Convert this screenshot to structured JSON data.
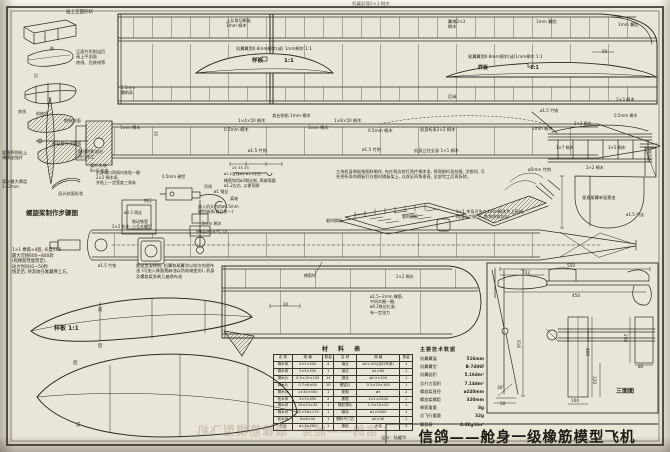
{
  "title_block": {
    "title": "信鸽——舱身一级橡筋模型飞机",
    "designer": "设计：陆耀华"
  },
  "material_table": {
    "title": "材  料  表",
    "headers": [
      "名 称",
      "规 格",
      "数量",
      "名 称",
      "规 格",
      "数量"
    ],
    "rows": [
      [
        "桐木条",
        "2×2×550",
        "4",
        "钢丝",
        "ø2×100(自行车条)",
        "1"
      ],
      [
        "桐木条",
        "2×3×550",
        "1",
        "钢丝",
        "ø1×80",
        "1"
      ],
      [
        "桐木片",
        "0.5×10×100",
        "14",
        "铜丝",
        "ø0.5×100",
        "1"
      ],
      [
        "桐木片",
        "0.7×8×80",
        "10",
        "硬铝片",
        "0.5×20×100",
        "1"
      ],
      [
        "桐木片",
        "1×30×550",
        "1",
        "垫圈",
        "ø5",
        "2"
      ],
      [
        "松木条",
        "3×3×550",
        "2",
        "橡筋",
        "1×1×2500",
        "1"
      ],
      [
        "桐木块",
        "10×25×35",
        "1",
        "橡胶薄片",
        "1.5×10×20",
        "1"
      ],
      [
        "桐木块",
        "22×36×170",
        "1",
        "蜡线",
        "ø1×5000",
        "1"
      ],
      [
        "松木块",
        "6×6×50",
        "1",
        "塑料气门芯",
        "ø2×30",
        "1"
      ],
      [
        "竹丝",
        "ø1.5×280",
        "1",
        "棉纸",
        "大张",
        "1"
      ]
    ]
  },
  "tech_data": {
    "title": "主要技术数据",
    "rows": [
      [
        "机翼翼展",
        "516mm"
      ],
      [
        "机翼翼型",
        "B-7406f"
      ],
      [
        "机翼面积",
        "5.16dm²"
      ],
      [
        "总升力面积",
        "7.14dm²"
      ],
      [
        "螺旋桨直径",
        "ø240mm"
      ],
      [
        "螺旋桨螺距",
        "320mm"
      ],
      [
        "橡筋重量",
        "8g"
      ],
      [
        "总飞行重量",
        "32g"
      ],
      [
        "翼载荷",
        "4.42g/dm²"
      ]
    ]
  },
  "labels": [
    {
      "t": "画上正面形状",
      "x": 66,
      "y": 10,
      "s": 4.5
    },
    {
      "t": "正面外形削出后\n画上平剖面\n棱线、后棱线等",
      "x": 76,
      "y": 49,
      "w": 38,
      "s": 4.2
    },
    {
      "t": "前",
      "x": 50,
      "y": 46,
      "s": 4
    },
    {
      "t": "后",
      "x": 34,
      "y": 73,
      "s": 4
    },
    {
      "t": "底线",
      "x": 18,
      "y": 109,
      "s": 4
    },
    {
      "t": "前棱线",
      "x": 36,
      "y": 111,
      "s": 4
    },
    {
      "t": "削制剖面",
      "x": 64,
      "y": 118,
      "s": 4.2
    },
    {
      "t": "紧贴桨叶成圆弧",
      "x": 52,
      "y": 141,
      "s": 4.2
    },
    {
      "t": "削除阴影部分\n再行加工",
      "x": 78,
      "y": 149,
      "w": 34,
      "s": 4.2
    },
    {
      "t": "桨根两侧贴上\n薄绸加强片",
      "x": 2,
      "y": 150,
      "w": 30,
      "s": 4.2
    },
    {
      "t": "桨叶木块\n8×8 松木",
      "x": 90,
      "y": 163,
      "w": 26,
      "s": 4.2
    },
    {
      "t": "桨叶最大厚度\n1~2mm",
      "x": 2,
      "y": 179,
      "w": 32,
      "s": 4.2
    },
    {
      "t": "设计剖面形状",
      "x": 58,
      "y": 191,
      "s": 4.2
    },
    {
      "t": "螺旋桨制作步骤图",
      "x": 26,
      "y": 209,
      "s": 6.5,
      "b": 1
    },
    {
      "t": "机翼前缘2×3 桐木",
      "x": 352,
      "y": 2,
      "s": 4.5
    },
    {
      "t": "上反角切断处\n1mm 桐木",
      "x": 226,
      "y": 18,
      "w": 34,
      "s": 4.2
    },
    {
      "t": "机翼翼肋0.8mm桐木(或) 1mm桐木 1:1",
      "x": 236,
      "y": 46,
      "s": 4.2
    },
    {
      "t": "样板",
      "x": 252,
      "y": 58,
      "s": 5.5,
      "b": 1
    },
    {
      "t": "1:1",
      "x": 284,
      "y": 58,
      "s": 5.5,
      "b": 1
    },
    {
      "t": "翼梢2×3\n桐木",
      "x": 448,
      "y": 19,
      "w": 26,
      "s": 4.2
    },
    {
      "t": "1mm 翼肋",
      "x": 536,
      "y": 19,
      "s": 4.2
    },
    {
      "t": "1mm 翼肋",
      "x": 618,
      "y": 22,
      "s": 4.2
    },
    {
      "t": "尾翼翼肋0.8mm桐木(或)1mm桐木 1:1",
      "x": 468,
      "y": 54,
      "s": 4.2
    },
    {
      "t": "样板",
      "x": 478,
      "y": 65,
      "s": 5,
      "b": 1
    },
    {
      "t": "1:1",
      "x": 530,
      "y": 65,
      "s": 5,
      "b": 1
    },
    {
      "t": "50",
      "x": 602,
      "y": 49,
      "s": 4.2
    },
    {
      "t": "后缘",
      "x": 448,
      "y": 94,
      "s": 4.2
    },
    {
      "t": "2×3 桐木",
      "x": 616,
      "y": 97,
      "s": 4.2
    },
    {
      "t": "1.5mm\n翼梢条",
      "x": 121,
      "y": 85,
      "w": 22,
      "s": 4
    },
    {
      "t": "1mm 桐木",
      "x": 120,
      "y": 125,
      "s": 4.2
    },
    {
      "t": "35",
      "x": 158,
      "y": 131,
      "s": 4,
      "r": 90
    },
    {
      "t": "1×4×50 桐木",
      "x": 238,
      "y": 118,
      "s": 4.2
    },
    {
      "t": "其右侧贴 1mm 桐木",
      "x": 272,
      "y": 113,
      "s": 4.2
    },
    {
      "t": "0.5mm 桐木",
      "x": 224,
      "y": 127,
      "s": 4.2
    },
    {
      "t": "1mm 桐木",
      "x": 308,
      "y": 125,
      "s": 4.2
    },
    {
      "t": "ø1.5 竹销",
      "x": 248,
      "y": 148,
      "s": 4.2
    },
    {
      "t": "1×8×50 桐木",
      "x": 334,
      "y": 118,
      "s": 4.2
    },
    {
      "t": "0.5mm 桐木",
      "x": 368,
      "y": 128,
      "s": 4.2
    },
    {
      "t": "机身桁条2×2 桐木",
      "x": 420,
      "y": 127,
      "s": 4.2
    },
    {
      "t": "1mm 桐木",
      "x": 532,
      "y": 126,
      "s": 4.2
    },
    {
      "t": "ø1.5 竹销",
      "x": 362,
      "y": 147,
      "s": 4.2
    },
    {
      "t": "机身立柱全部 1×1 桐木",
      "x": 414,
      "y": 148,
      "s": 4.2
    },
    {
      "t": "ø5mm 竹销",
      "x": 528,
      "y": 167,
      "s": 4.2
    },
    {
      "t": "25    35    25",
      "x": 232,
      "y": 166,
      "s": 3.8
    },
    {
      "t": "ø1.2左右  ø2  ø1.2左右",
      "x": 224,
      "y": 172,
      "s": 3.6
    },
    {
      "t": "橡筋钩用ø2钢丝制, 两端弯圆\nø1.2左右, 以便弯脚",
      "x": 224,
      "y": 178,
      "w": 66,
      "s": 4
    },
    {
      "t": "机身端口四周内各贴一圈\n2×2 桐木条,\n并贴上一定宽度三角条",
      "x": 96,
      "y": 170,
      "w": 62,
      "s": 4
    },
    {
      "t": "0.5mm 硬铝",
      "x": 162,
      "y": 174,
      "s": 4
    },
    {
      "t": "吊线",
      "x": 204,
      "y": 184,
      "s": 4
    },
    {
      "t": "ø1 钢丝",
      "x": 214,
      "y": 189,
      "s": 4
    },
    {
      "t": "桨轴",
      "x": 230,
      "y": 196,
      "s": 4
    },
    {
      "t": "热压",
      "x": 144,
      "y": 198,
      "s": 4
    },
    {
      "t": "ø0.3 铜丝",
      "x": 124,
      "y": 210,
      "s": 4
    },
    {
      "t": "嵌入机头内的ø0.5mm\n硬铝轴承(前后各一)",
      "x": 198,
      "y": 204,
      "w": 58,
      "s": 4
    },
    {
      "t": "制动铁管\n小号木螺钉",
      "x": 132,
      "y": 219,
      "w": 28,
      "s": 4
    },
    {
      "t": "2mm 桐木",
      "x": 202,
      "y": 221,
      "s": 4
    },
    {
      "t": "塑料自行车气门芯",
      "x": 196,
      "y": 229,
      "s": 4
    },
    {
      "t": "2×2 松木",
      "x": 112,
      "y": 224,
      "s": 4
    },
    {
      "t": "三块机身侧板按图样制作, 先在两边各钉两片桐木条, 将两根桁条刨直, 涂胶时, 可先把桁条和隔板钉在临时隔板架上, 以保证四角垂直, 全部完工后再拆除。",
      "x": 336,
      "y": 169,
      "w": 152,
      "s": 4.2
    },
    {
      "t": "临时隔板",
      "x": 326,
      "y": 218,
      "s": 4
    },
    {
      "t": "临时隔板",
      "x": 402,
      "y": 214,
      "s": 4
    },
    {
      "t": "1×1 木条可先在1mm桐木片上画线,\n再用小刀割下, 其木质较均匀",
      "x": 456,
      "y": 209,
      "w": 104,
      "s": 4.2
    },
    {
      "t": "ø1.5 竹销",
      "x": 540,
      "y": 108,
      "s": 4
    },
    {
      "t": "2×3 桐木",
      "x": 574,
      "y": 121,
      "s": 4
    },
    {
      "t": "0.5mm 桐木",
      "x": 614,
      "y": 113,
      "s": 4
    },
    {
      "t": "1×7 桐木",
      "x": 556,
      "y": 145,
      "s": 4
    },
    {
      "t": "3×5 桐木",
      "x": 608,
      "y": 145,
      "s": 4
    },
    {
      "t": "2×2 桐木",
      "x": 586,
      "y": 165,
      "s": 4
    },
    {
      "t": "垫高板",
      "x": 652,
      "y": 150,
      "s": 4,
      "r": 90
    },
    {
      "t": "垂直尾翼单面蒙皮",
      "x": 582,
      "y": 195,
      "w": 44,
      "s": 4.2
    },
    {
      "t": "ø1.5 竹丝",
      "x": 626,
      "y": 212,
      "s": 4
    },
    {
      "t": "1×1 橡筋×4股, 长度400\n最大可绕600~800转\n(视橡筋性能而定),\n动力时间42~50秒\n绕足后, 将其收在尾翼撑上方。",
      "x": 12,
      "y": 248,
      "w": 98,
      "s": 4.3
    },
    {
      "t": "ø1.5 竹销",
      "x": 98,
      "y": 263,
      "s": 4
    },
    {
      "t": "蒙皮用湿绵纸, 机翼和尾翼涂以较冷的透布油 (可加入微量蓖麻油以防收缩变形), 机身及螺旋桨多刷几遍透布油",
      "x": 136,
      "y": 263,
      "w": 80,
      "s": 4.2
    },
    {
      "t": "橡筋钩",
      "x": 304,
      "y": 273,
      "s": 4
    },
    {
      "t": "2×2 桐木",
      "x": 396,
      "y": 274,
      "s": 4
    },
    {
      "t": "30",
      "x": 283,
      "y": 302,
      "s": 4
    },
    {
      "t": "ø1.5~2mm 橡筋,\n中间木圈一圈,\nø0.2铁丝扎紧,\n有一定张力",
      "x": 370,
      "y": 294,
      "w": 48,
      "s": 4
    },
    {
      "t": "前",
      "x": 98,
      "y": 308,
      "s": 4.5
    },
    {
      "t": "样板  1:1",
      "x": 54,
      "y": 325,
      "s": 6,
      "b": 1
    },
    {
      "t": "后",
      "x": 98,
      "y": 344,
      "s": 4.5
    },
    {
      "t": "后",
      "x": 73,
      "y": 361,
      "s": 4.5
    },
    {
      "t": "前",
      "x": 76,
      "y": 423,
      "s": 4.5
    },
    {
      "t": "550",
      "x": 567,
      "y": 263,
      "s": 4.2
    },
    {
      "t": "142",
      "x": 522,
      "y": 270,
      "s": 4.2
    },
    {
      "t": "450",
      "x": 572,
      "y": 293,
      "s": 4.2
    },
    {
      "t": "516",
      "x": 521,
      "y": 340,
      "s": 4.2,
      "r": 90
    },
    {
      "t": "400",
      "x": 590,
      "y": 348,
      "s": 4.2,
      "r": 90
    },
    {
      "t": "250",
      "x": 628,
      "y": 334,
      "s": 4.2,
      "r": 90
    },
    {
      "t": "120",
      "x": 597,
      "y": 376,
      "s": 4.2,
      "r": 90
    },
    {
      "t": "100",
      "x": 571,
      "y": 398,
      "s": 4.2
    },
    {
      "t": "80",
      "x": 638,
      "y": 364,
      "s": 4.2
    },
    {
      "t": "50",
      "x": 500,
      "y": 401,
      "s": 4.2
    },
    {
      "t": "30°",
      "x": 497,
      "y": 385,
      "s": 4.2
    },
    {
      "t": "三面图",
      "x": 616,
      "y": 388,
      "s": 6,
      "b": 1
    }
  ]
}
